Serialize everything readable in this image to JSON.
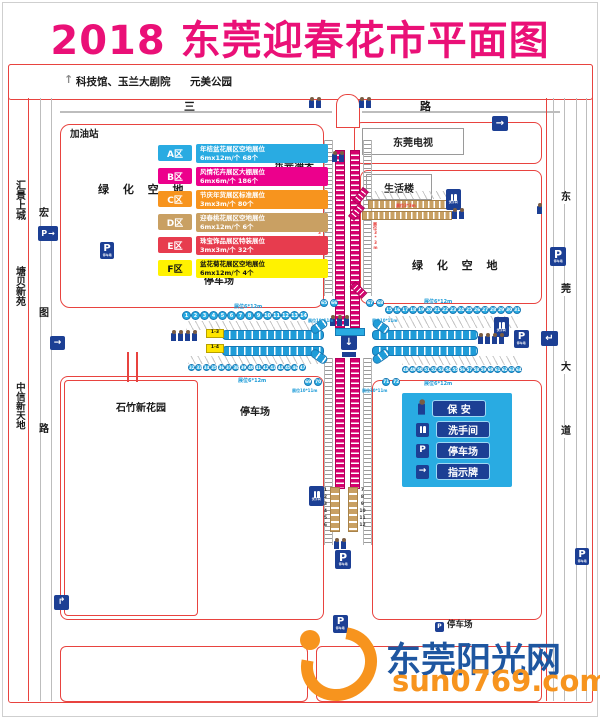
{
  "page": {
    "title": "2018 东莞迎春花市平面图"
  },
  "colors": {
    "title": "#EA1077",
    "road_outline": "#E8433F",
    "sign_navy": "#1C3F94",
    "legend_bg": "#29ABE2",
    "zone_a": "#29ABE2",
    "zone_b": "#EC008C",
    "zone_c": "#F7941E",
    "zone_d": "#C9A063",
    "zone_e": "#E73C4E",
    "zone_f": "#FFF200",
    "stall_blue": "#1F9CD8",
    "stall_magenta": "#D6006E",
    "stall_tan": "#C9A063",
    "logo_blue": "#1E56A0",
    "logo_orange": "#F7941E"
  },
  "top_area": {
    "up_arrow": "↑",
    "landmark": "科技馆、玉兰大剧院",
    "park": "元美公园"
  },
  "roads": {
    "sanyuan": {
      "c1": "三",
      "c2": "元",
      "c3": "路"
    },
    "hongtu": {
      "c1": "宏",
      "c2": "图",
      "c3": "路"
    },
    "dongguan_ave": {
      "c1": "东",
      "c2": "莞",
      "c3": "大",
      "c4": "道"
    }
  },
  "places": {
    "gas_station": "加油站",
    "huijing": "汇景上城",
    "tangbei": "塘贝新苑",
    "zhongxin": "中信新天地",
    "green_west": "绿 化 空 地",
    "green_east": "绿 化 空 地",
    "customs": "东莞海关",
    "tv": "东莞电视",
    "life_building": "生活楼",
    "shizhu": "石竹新花园",
    "parking_nw": "停车场",
    "parking_sw": "停车场",
    "parking_bottom": "停车场"
  },
  "zones": [
    {
      "id": "A区",
      "color": "#29ABE2",
      "line1": "年桔盆花展区空地展位",
      "line2": "6mx12m/个  68个"
    },
    {
      "id": "B区",
      "color": "#EC008C",
      "line1": "风情花卉展区大棚展位",
      "line2": "6mx6m/个  186个"
    },
    {
      "id": "C区",
      "color": "#F7941E",
      "line1": "节庆年货展区标准展位",
      "line2": "3mx3m/个  80个"
    },
    {
      "id": "D区",
      "color": "#C9A063",
      "line1": "迎春桃花展区空地展位",
      "line2": "6mx12m/个  6个"
    },
    {
      "id": "E区",
      "color": "#E73C4E",
      "line1": "珠宝饰品展区特装展位",
      "line2": "3mx3m/个  32个"
    },
    {
      "id": "F区",
      "color": "#FFF200",
      "line1": "盆花菊花展区空地展位",
      "line2": "6mx12m/个  4个"
    }
  ],
  "legend": {
    "items": [
      {
        "icon": "guard-icon",
        "label": "保 安"
      },
      {
        "icon": "toilet-icon",
        "label": "洗手间"
      },
      {
        "icon": "parking-icon",
        "label": "停车场"
      },
      {
        "icon": "direction-sign-icon",
        "label": "指示牌"
      }
    ]
  },
  "signs": {
    "p": "P",
    "parking_sub": "停车场",
    "toilet_sub": "洗手间",
    "right": "→",
    "left_hook": "↵",
    "up_hook": "↱",
    "down": "↓"
  },
  "stall_labels": {
    "s6x12": "展位6*12m",
    "s10x11": "展位10*11m",
    "s3x3": "展位3*3m"
  },
  "stall_numbers": {
    "west_top": [
      1,
      2,
      3,
      4,
      5,
      6,
      7,
      8,
      9,
      10,
      11,
      12,
      13,
      14
    ],
    "east_top": [
      15,
      16,
      17,
      18,
      19,
      20,
      21,
      22,
      23,
      24,
      25,
      26,
      27,
      28,
      29,
      30,
      31
    ],
    "west_bottom": [
      32,
      33,
      34,
      35,
      36,
      37,
      38,
      39,
      40,
      41,
      42,
      43,
      44,
      45,
      46,
      47
    ],
    "east_bottom": [
      48,
      49,
      50,
      51,
      52,
      53,
      54,
      55,
      56,
      57,
      58,
      59,
      60,
      61,
      62,
      63,
      64
    ],
    "pair_nw": [
      65,
      66
    ],
    "pair_ne": [
      67,
      68
    ],
    "pair_sw": [
      69,
      70
    ],
    "pair_se": [
      71,
      72
    ],
    "south_left": [
      1,
      2,
      3,
      4,
      5,
      6
    ],
    "south_right": [
      7,
      8,
      9,
      10,
      11,
      12
    ]
  },
  "yellow_stalls": {
    "top": "1-3",
    "bottom": "1-4"
  },
  "watermark": {
    "name": "东莞阳光网",
    "url": "sun0769.com"
  }
}
